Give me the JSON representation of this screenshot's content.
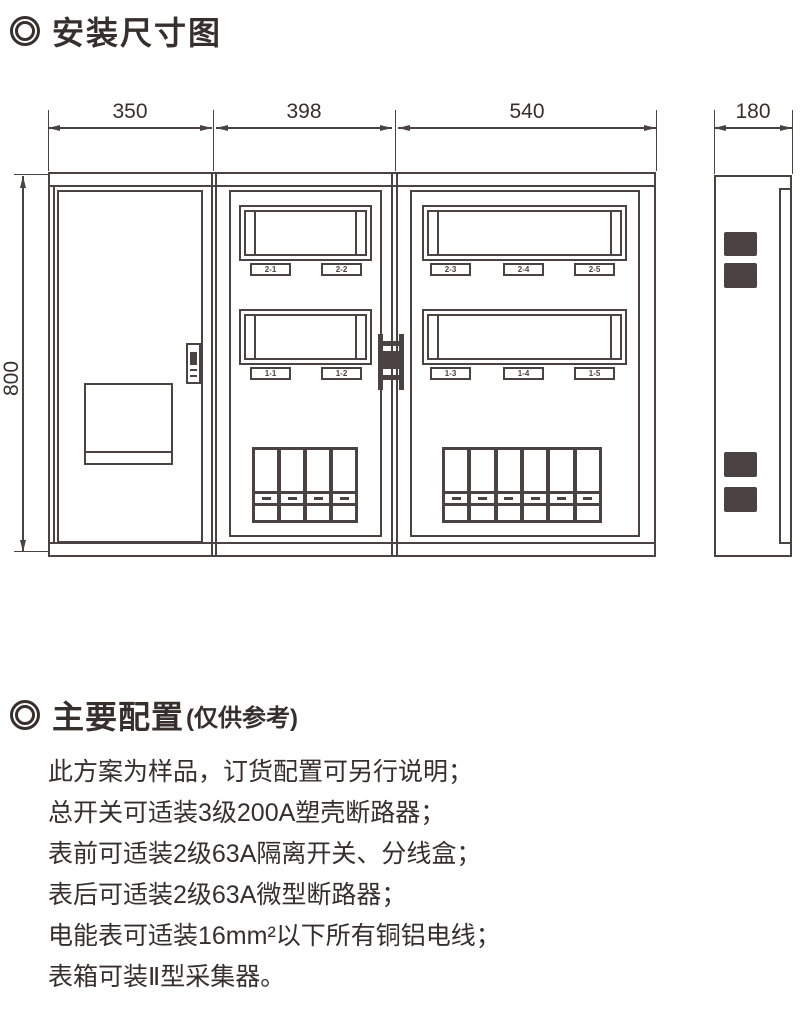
{
  "header": {
    "title": "安装尺寸图"
  },
  "dimensions": {
    "front_widths": [
      "350",
      "398",
      "540"
    ],
    "side_width": "180",
    "height": "800"
  },
  "meter_labels": {
    "mid_top": [
      "2-1",
      "2-2"
    ],
    "mid_bottom": [
      "1-1",
      "1-2"
    ],
    "right_top": [
      "2-3",
      "2-4",
      "2-5"
    ],
    "right_bottom": [
      "1-3",
      "1-4",
      "1-5"
    ]
  },
  "config": {
    "heading": "主要配置",
    "note": "(仅供参考)",
    "lines": [
      "此方案为样品，订货配置可另行说明；",
      "总开关可适装3级200A塑壳断路器；",
      "表前可适装2级63A隔离开关、分线盒；",
      "表后可适装2级63A微型断路器；",
      "电能表可适装16mm²以下所有铜铝电线；",
      "表箱可装Ⅱ型采集器。"
    ]
  }
}
